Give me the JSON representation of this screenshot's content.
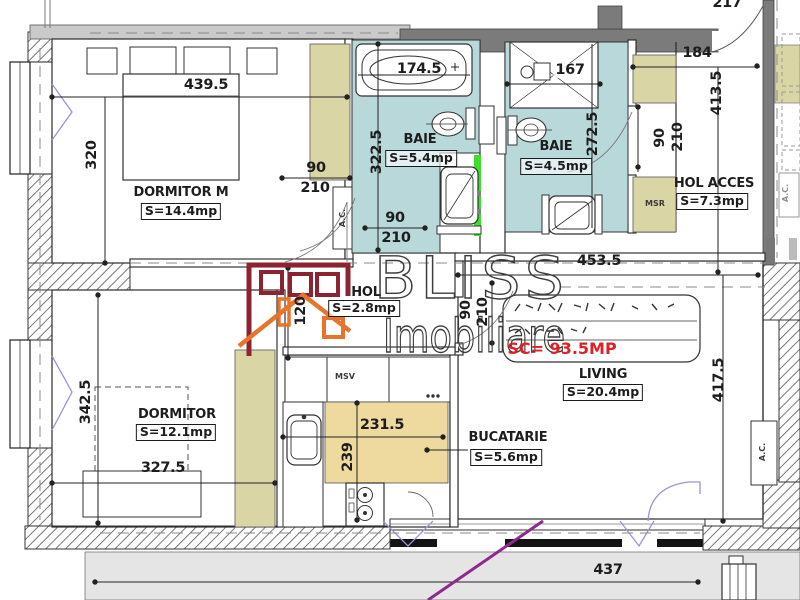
{
  "watermark": {
    "brand": "BLISS",
    "suffix": "Imobiliare"
  },
  "total": {
    "sc": "SC= 93.5MP"
  },
  "rooms": {
    "dormitor_m": {
      "name": "DORMITOR M",
      "area": "S=14.4mp"
    },
    "baie_1": {
      "name": "BAIE",
      "area": "S=5.4mp"
    },
    "baie_2": {
      "name": "BAIE",
      "area": "S=4.5mp"
    },
    "hol_acces": {
      "name": "HOL ACCES",
      "area": "S=7.3mp"
    },
    "hol": {
      "name": "HOL",
      "area": "S=2.8mp"
    },
    "living": {
      "name": "LIVING",
      "area": "S=20.4mp"
    },
    "dormitor": {
      "name": "DORMITOR",
      "area": "S=12.1mp"
    },
    "bucatarie": {
      "name": "BUCATARIE",
      "area": "S=5.6mp"
    }
  },
  "dims": {
    "w_dorm_m": "439.5",
    "h_dorm_m": "320",
    "w_tub": "174.5",
    "w_shower": "167",
    "w_acces": "184",
    "h_acces": "413.5",
    "w_entry": "217",
    "w_living": "453.5",
    "h_living": "417.5",
    "w_balcony": "437",
    "w_dorm": "327.5",
    "h_dorm": "342.5",
    "w_kitchen": "231.5",
    "h_kitchen": "239",
    "h_hol": "120",
    "door_w": "90",
    "door_h": "210"
  },
  "labels": {
    "msr": "MSR",
    "msv": "MSV",
    "ac": "A.C."
  },
  "colors": {
    "bath": "#b9d8da",
    "closet": "#d9d5a5",
    "counter": "#eeda9e",
    "balcony": "#e5e5e5",
    "wall_dark": "#7b7b7b",
    "wall_light": "#cacaca",
    "green": "#3ade2b",
    "purple": "#8e2a8e",
    "red": "#df2127",
    "logo_maroon": "#8c2330",
    "logo_orange": "#e8742c",
    "watermark": "#3c3c3c"
  }
}
